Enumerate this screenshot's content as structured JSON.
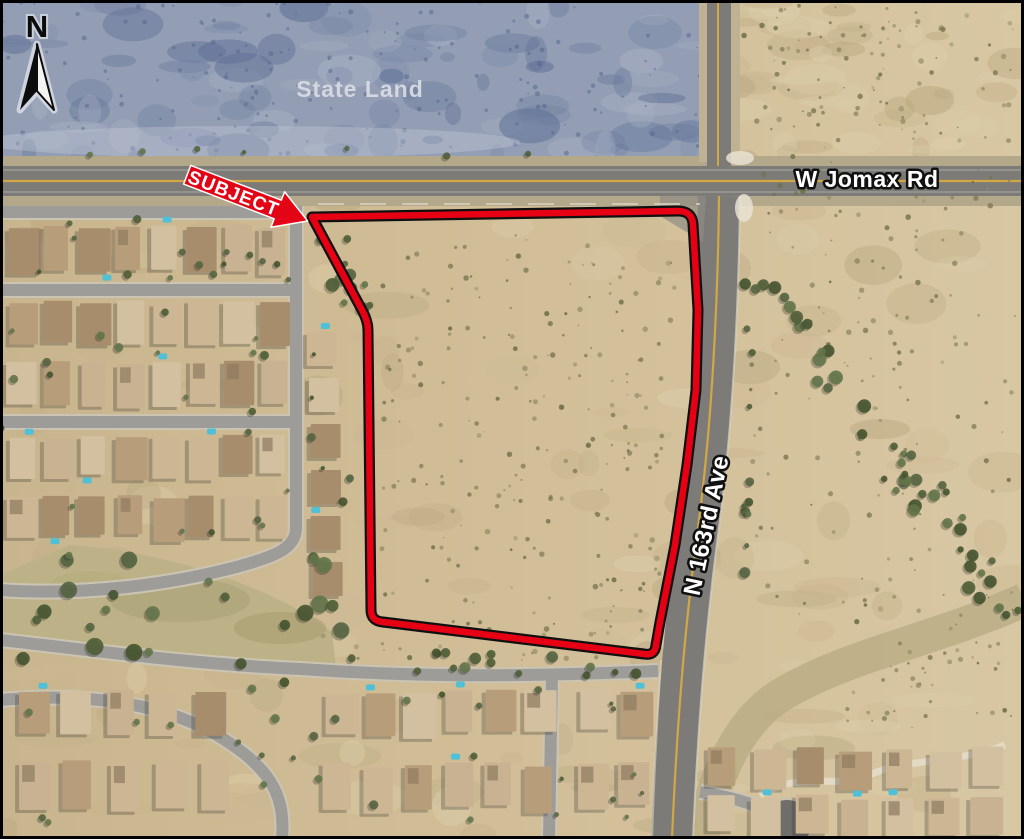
{
  "map": {
    "type": "aerial-property-exhibit",
    "north_label": "N",
    "labels": {
      "state_land": "State Land",
      "jomax_road": "W Jomax Rd",
      "ave_163rd": "N 163rd Ave",
      "subject": "SUBJECT"
    },
    "colors": {
      "parcel_outline": "#e70013",
      "parcel_casing": "#101010",
      "subject_arrow": "#e60012",
      "road_centerline": "#d2a845",
      "state_land_tint": "#939eb4",
      "desert": "#cfbd97",
      "asphalt": "#7c7b78",
      "label_text": "#ffffff",
      "label_halo": "#111111"
    }
  }
}
